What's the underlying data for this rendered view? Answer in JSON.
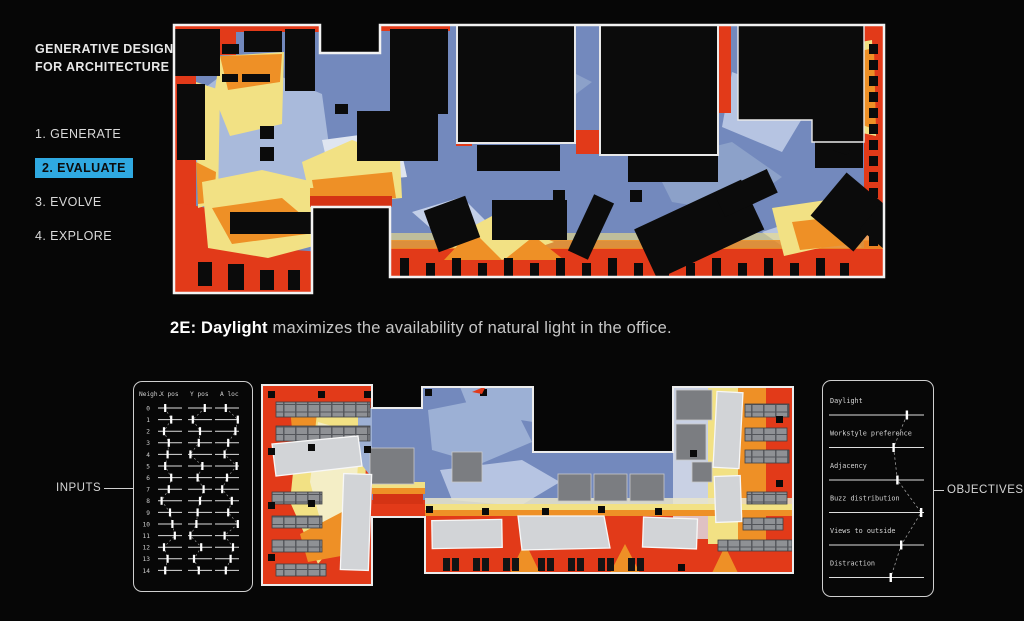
{
  "palette": {
    "background": "#060606",
    "highlight_blue": "#2fa9e1",
    "heat_red": "#e23a19",
    "heat_orange": "#ee9026",
    "heat_yellow": "#f2e184",
    "heat_blue": "#7389bd",
    "heat_light_blue": "#b6c4e2",
    "panel_stroke": "#cfcfcf"
  },
  "sidebar": {
    "title": [
      "GENERATIVE DESIGN",
      "FOR ARCHITECTURE"
    ],
    "steps": [
      {
        "label": "1. GENERATE",
        "active": false
      },
      {
        "label": "2. EVALUATE",
        "active": true
      },
      {
        "label": "3. EVOLVE",
        "active": false
      },
      {
        "label": "4. EXPLORE",
        "active": false
      }
    ]
  },
  "caption": {
    "bold": "2E: Daylight",
    "rest": " maximizes the availability of natural light in the office."
  },
  "inputs_panel": {
    "label": "INPUTS",
    "headers": [
      "Neigh.",
      "X pos",
      "Y pos",
      "A loc"
    ],
    "rows": [
      {
        "id": "0",
        "values": [
          0.3,
          0.7,
          0.45
        ]
      },
      {
        "id": "1",
        "values": [
          0.55,
          0.2,
          0.95
        ]
      },
      {
        "id": "2",
        "values": [
          0.25,
          0.5,
          0.85
        ]
      },
      {
        "id": "3",
        "values": [
          0.45,
          0.45,
          0.55
        ]
      },
      {
        "id": "4",
        "values": [
          0.4,
          0.1,
          0.4
        ]
      },
      {
        "id": "5",
        "values": [
          0.3,
          0.6,
          0.9
        ]
      },
      {
        "id": "6",
        "values": [
          0.55,
          0.4,
          0.5
        ]
      },
      {
        "id": "7",
        "values": [
          0.45,
          0.65,
          0.3
        ]
      },
      {
        "id": "8",
        "values": [
          0.15,
          0.5,
          0.7
        ]
      },
      {
        "id": "9",
        "values": [
          0.5,
          0.4,
          0.55
        ]
      },
      {
        "id": "10",
        "values": [
          0.6,
          0.35,
          0.95
        ]
      },
      {
        "id": "11",
        "values": [
          0.7,
          0.1,
          0.4
        ]
      },
      {
        "id": "12",
        "values": [
          0.25,
          0.55,
          0.75
        ]
      },
      {
        "id": "13",
        "values": [
          0.4,
          0.25,
          0.65
        ]
      },
      {
        "id": "14",
        "values": [
          0.3,
          0.45,
          0.45
        ]
      }
    ]
  },
  "objectives_panel": {
    "label": "OBJECTIVES",
    "items": [
      {
        "label": "Daylight",
        "value": 0.82
      },
      {
        "label": "Workstyle preference",
        "value": 0.68
      },
      {
        "label": "Adjacency",
        "value": 0.72
      },
      {
        "label": "Buzz distribution",
        "value": 0.97
      },
      {
        "label": "Views to outside",
        "value": 0.76
      },
      {
        "label": "Distraction",
        "value": 0.65
      }
    ]
  }
}
